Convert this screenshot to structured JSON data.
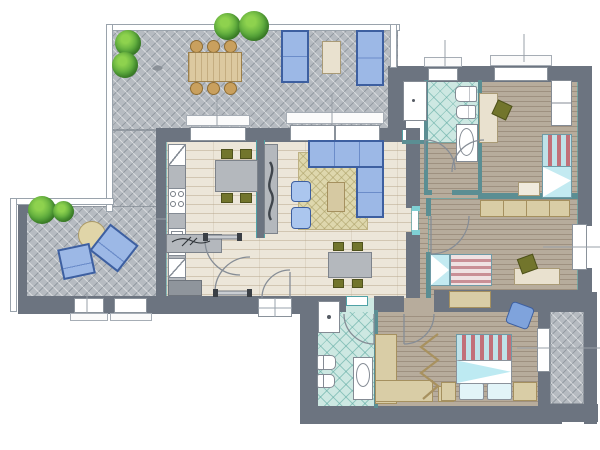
{
  "title": "apartment-floor-plan",
  "view": "architectural-top-down-2d",
  "palette": {
    "wall": "#6c7480",
    "thin_wall": "#5b8e93",
    "teal_edge": "#4fa2a6",
    "terrace_paving": "#b6bbc1",
    "wood_floor": "#ece6d9",
    "bedroom_floor": "#b7ac9c",
    "bath_tile": "#cde8e2",
    "rug": "#ded7ad",
    "wood_furniture": "#d9cda6",
    "gray_furniture": "#b4b8bd",
    "olive_chair": "#72752c",
    "sofa_blue": "#9cb8e6",
    "sofa_border_blue": "#3d5fa0",
    "bed_aqua": "#c3eaf1",
    "bed_stripe_red": "#c27079",
    "greenery": "#5aa83c",
    "white_fixture": "#ffffff"
  },
  "rooms": [
    {
      "name": "upper-terrace",
      "floor": "herringbone-paving",
      "furniture": [
        "outdoor-dining-table",
        "six-round-chairs",
        "two-blue-sofas",
        "coffee-table",
        "three-trees",
        "bird-ornament"
      ]
    },
    {
      "name": "lower-terrace",
      "floor": "herringbone-paving",
      "furniture": [
        "round-table",
        "two-blue-lounge-chairs",
        "two-shrubs"
      ]
    },
    {
      "name": "kitchen-dining",
      "floor": "wood-plank",
      "furniture": [
        "kitchen-counter",
        "corner-cabinet",
        "stove-4-burners",
        "double-sink",
        "dining-table",
        "four-olive-chairs",
        "sideboard-with-decor"
      ]
    },
    {
      "name": "living-room",
      "floor": "wood-plank",
      "furniture": [
        "corner-sofa",
        "area-rug",
        "coffee-table",
        "two-armchair-poufs",
        "tv-lowboard",
        "dining-table",
        "four-olive-chairs"
      ]
    },
    {
      "name": "hallway",
      "floor": "wood-plank",
      "furniture": [
        "entrance-door",
        "interior-doors"
      ]
    },
    {
      "name": "storage-closet",
      "floor": "white",
      "furniture": [
        "cabinet"
      ]
    },
    {
      "name": "bathroom-1",
      "floor": "teal-diamond-tile",
      "furniture": [
        "toilet",
        "bidet",
        "washbasin"
      ]
    },
    {
      "name": "bedroom-1",
      "floor": "wood-strip",
      "furniture": [
        "single-bed-striped",
        "desk",
        "olive-chair",
        "wardrobe",
        "rug-mat"
      ]
    },
    {
      "name": "bedroom-2",
      "floor": "wood-strip",
      "furniture": [
        "single-bed-striped",
        "desk",
        "olive-chair",
        "wardrobe-row",
        "dresser"
      ]
    },
    {
      "name": "bedroom-3",
      "floor": "wood-strip",
      "furniture": [
        "double-bed-striped",
        "two-pillows",
        "two-nightstands",
        "l-shaped-wardrobe",
        "blue-chair",
        "accordion-door"
      ]
    },
    {
      "name": "bathroom-2",
      "floor": "teal-diamond-tile",
      "furniture": [
        "washing-machine",
        "toilet",
        "bidet",
        "washbasin"
      ]
    },
    {
      "name": "balcony",
      "floor": "herringbone-paving",
      "furniture": []
    }
  ],
  "openings": {
    "windows": 8,
    "exterior_doors": 2,
    "interior_door_arcs": 8
  }
}
